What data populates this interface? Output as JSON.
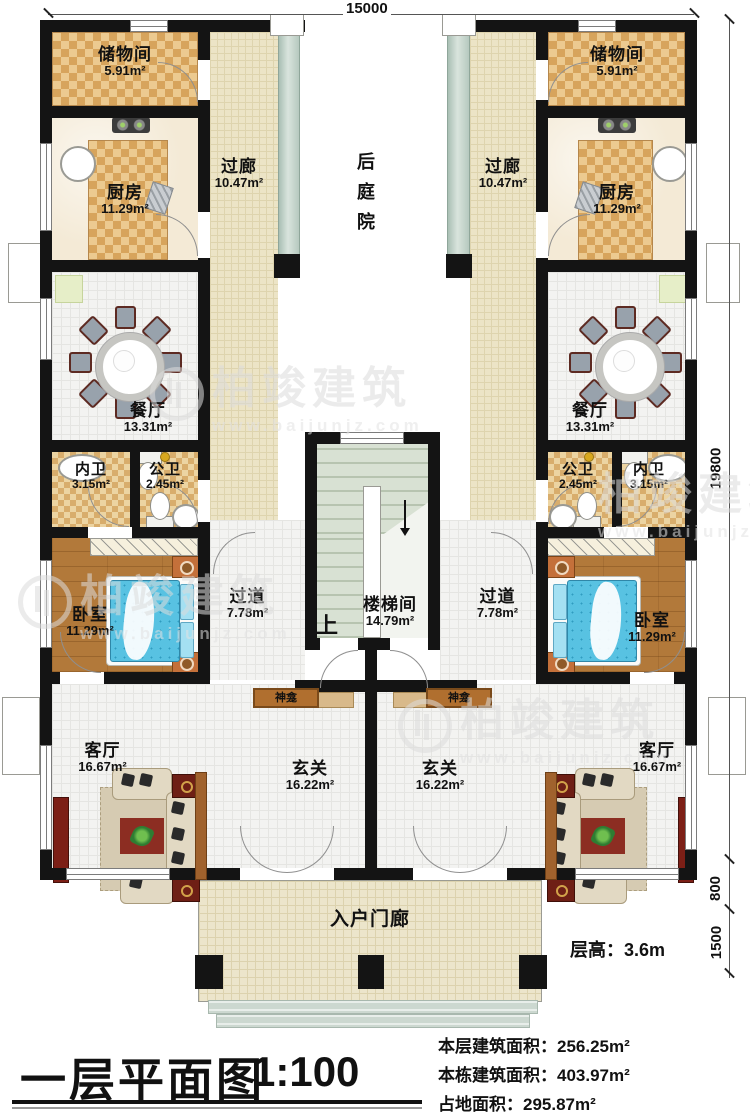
{
  "plan_title": {
    "name": "一层平面图",
    "scale": "1:100"
  },
  "stats": {
    "line1_label": "本层建筑面积：",
    "line1_value": "256.25m²",
    "line2_label": "本栋建筑面积：",
    "line2_value": "403.97m²",
    "line3_label": "占地面积：",
    "line3_value": "295.87m²"
  },
  "floor_height": {
    "label": "层高：",
    "value": "3.6m"
  },
  "dimensions": {
    "top_width": "15000",
    "right_height": "19800",
    "right_step": "800",
    "right_porch": "1500"
  },
  "watermark": {
    "brand": "柏竣建筑",
    "url": "www.baijunjz.com"
  },
  "rooms": {
    "storage_l": {
      "name": "储物间",
      "area": "5.91m²"
    },
    "storage_r": {
      "name": "储物间",
      "area": "5.91m²"
    },
    "corridor_l": {
      "name": "过廊",
      "area": "10.47m²"
    },
    "corridor_r": {
      "name": "过廊",
      "area": "10.47m²"
    },
    "kitchen_l": {
      "name": "厨房",
      "area": "11.29m²"
    },
    "kitchen_r": {
      "name": "厨房",
      "area": "11.29m²"
    },
    "courtyard": {
      "name": "后庭院"
    },
    "dining_l": {
      "name": "餐厅",
      "area": "13.31m²"
    },
    "dining_r": {
      "name": "餐厅",
      "area": "13.31m²"
    },
    "bath_private_l": {
      "name": "内卫",
      "area": "3.15m²"
    },
    "bath_public_l": {
      "name": "公卫",
      "area": "2.45m²"
    },
    "bath_public_r": {
      "name": "公卫",
      "area": "2.45m²"
    },
    "bath_private_r": {
      "name": "内卫",
      "area": "3.15m²"
    },
    "bedroom_l": {
      "name": "卧室",
      "area": "11.29m²"
    },
    "bedroom_r": {
      "name": "卧室",
      "area": "11.29m²"
    },
    "hallway_l": {
      "name": "过道",
      "area": "7.78m²"
    },
    "hallway_r": {
      "name": "过道",
      "area": "7.78m²"
    },
    "stairwell": {
      "name": "楼梯间",
      "area": "14.79m²",
      "direction": "上"
    },
    "shrine_l": {
      "name": "神龛"
    },
    "shrine_r": {
      "name": "神龛"
    },
    "living_l": {
      "name": "客厅",
      "area": "16.67m²"
    },
    "living_r": {
      "name": "客厅",
      "area": "16.67m²"
    },
    "foyer_l": {
      "name": "玄关",
      "area": "16.22m²"
    },
    "foyer_r": {
      "name": "玄关",
      "area": "16.22m²"
    },
    "porch": {
      "name": "入户门廊"
    }
  }
}
